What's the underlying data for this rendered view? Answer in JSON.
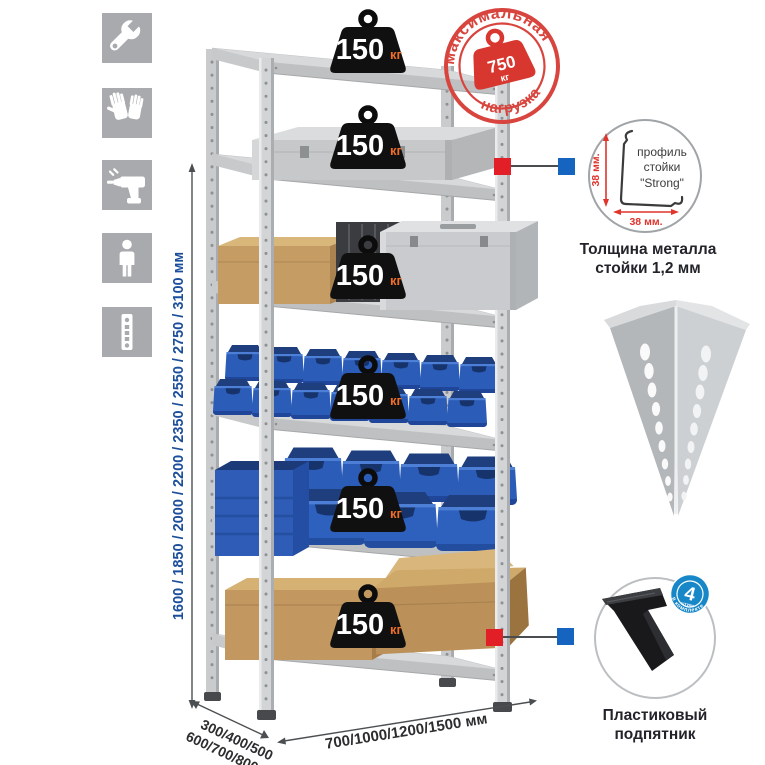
{
  "icons": [
    {
      "name": "wrench"
    },
    {
      "name": "gloves"
    },
    {
      "name": "drill"
    },
    {
      "name": "person"
    },
    {
      "name": "perforated-strip"
    }
  ],
  "dimensions": {
    "height": "1600 / 1850 / 2000 / 2200 / 2350 / 2550 / 2750 / 3100 мм",
    "depth_line1": "300/400/500",
    "depth_line2": "600/700/800 мм",
    "width": "700/1000/1200/1500 мм"
  },
  "badges": [
    {
      "value": "150",
      "unit": "кг"
    },
    {
      "value": "150",
      "unit": "кг"
    },
    {
      "value": "150",
      "unit": "кг"
    },
    {
      "value": "150",
      "unit": "кг"
    },
    {
      "value": "150",
      "unit": "кг"
    },
    {
      "value": "150",
      "unit": "кг"
    }
  ],
  "stamp": {
    "arc_top": "максимальная",
    "arc_bottom": "нагрузка",
    "weight_value": "750",
    "weight_unit": "кг"
  },
  "profile_detail": {
    "line1": "профиль",
    "line2": "стойки",
    "line3": "\"Strong\"",
    "dim_v": "38 мм.",
    "dim_h": "38 мм.",
    "caption1": "Толщина металла",
    "caption2": "стойки 1,2 мм"
  },
  "foot_detail": {
    "count": "4",
    "count_label": "штуки",
    "arc_label": "в комплекте",
    "caption1": "Пластиковый",
    "caption2": "подпятник"
  },
  "colors": {
    "accent_red": "#e21f26",
    "accent_blue": "#1565c0",
    "dim_text_blue": "#1b4e9b",
    "stamp_red": "#d8453e",
    "badge_unit_orange": "#ee6e28",
    "bin_blue": "#2b5cb8",
    "icon_tile_gray": "#a8aaad"
  }
}
